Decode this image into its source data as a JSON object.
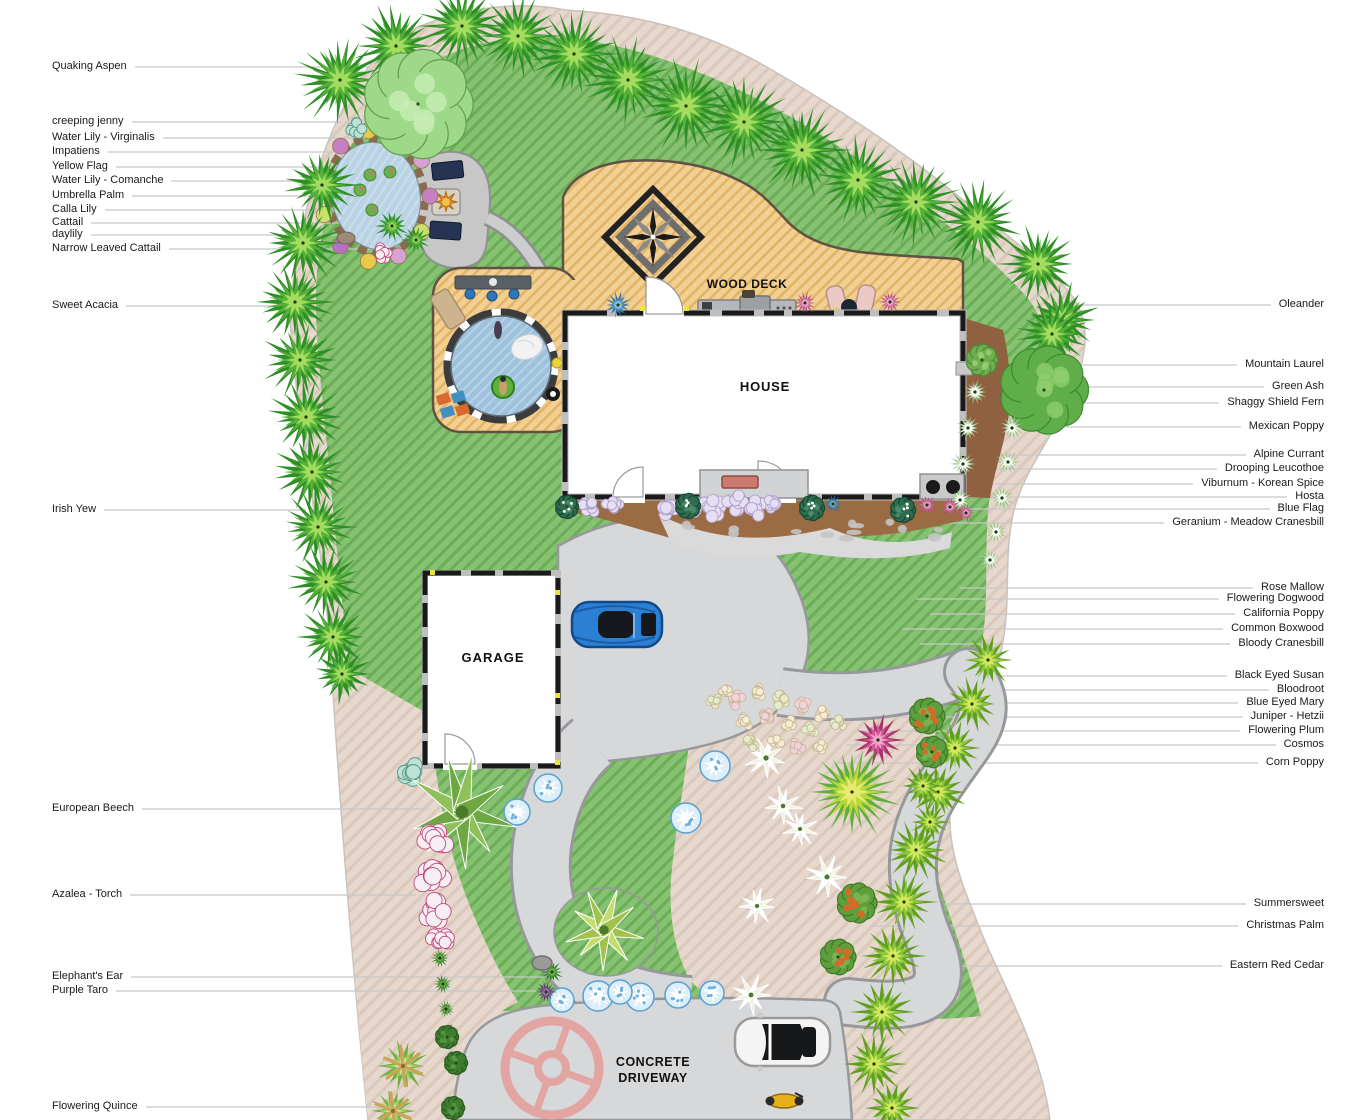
{
  "plan": {
    "wood_deck": "WOOD DECK",
    "house": "HOUSE",
    "garage": "GARAGE",
    "driveway_line1": "CONCRETE",
    "driveway_line2": "DRIVEWAY"
  },
  "plant_labels_left": [
    {
      "label": "Quaking Aspen",
      "y": 67,
      "tx": 370
    },
    {
      "label": "creeping jenny",
      "y": 122,
      "tx": 342
    },
    {
      "label": "Water Lily - Virginalis",
      "y": 138,
      "tx": 368
    },
    {
      "label": "Impatiens",
      "y": 152,
      "tx": 334
    },
    {
      "label": "Yellow Flag",
      "y": 167,
      "tx": 342
    },
    {
      "label": "Water Lily - Comanche",
      "y": 181,
      "tx": 362
    },
    {
      "label": "Umbrella Palm",
      "y": 196,
      "tx": 352
    },
    {
      "label": "Calla Lily",
      "y": 210,
      "tx": 346
    },
    {
      "label": "Cattail",
      "y": 223,
      "tx": 356
    },
    {
      "label": "daylily",
      "y": 235,
      "tx": 348
    },
    {
      "label": "Narrow Leaved Cattail",
      "y": 249,
      "tx": 386
    },
    {
      "label": "Sweet Acacia",
      "y": 306,
      "tx": 286
    },
    {
      "label": "Irish Yew",
      "y": 510,
      "tx": 306
    },
    {
      "label": "European Beech",
      "y": 809,
      "tx": 428
    },
    {
      "label": "Azalea - Torch",
      "y": 895,
      "tx": 416
    },
    {
      "label": "Elephant's Ear",
      "y": 977,
      "tx": 544
    },
    {
      "label": "Purple Taro",
      "y": 991,
      "tx": 536
    },
    {
      "label": "Flowering Quince",
      "y": 1107,
      "tx": 382
    }
  ],
  "plant_labels_right": [
    {
      "label": "Oleander",
      "y": 305,
      "tx": 1076
    },
    {
      "label": "Mountain Laurel",
      "y": 365,
      "tx": 1050
    },
    {
      "label": "Green Ash",
      "y": 387,
      "tx": 1008
    },
    {
      "label": "Shaggy Shield Fern",
      "y": 403,
      "tx": 1006
    },
    {
      "label": "Mexican Poppy",
      "y": 427,
      "tx": 1032
    },
    {
      "label": "Alpine Currant",
      "y": 455,
      "tx": 990
    },
    {
      "label": "Drooping Leucothoe",
      "y": 469,
      "tx": 976
    },
    {
      "label": "Viburnum - Korean Spice",
      "y": 484,
      "tx": 944
    },
    {
      "label": "Hosta",
      "y": 497,
      "tx": 900
    },
    {
      "label": "Blue Flag",
      "y": 509,
      "tx": 870
    },
    {
      "label": "Geranium - Meadow Cranesbill",
      "y": 523,
      "tx": 834
    },
    {
      "label": "Rose Mallow",
      "y": 588,
      "tx": 960
    },
    {
      "label": "Flowering Dogwood",
      "y": 599,
      "tx": 916
    },
    {
      "label": "California Poppy",
      "y": 614,
      "tx": 930
    },
    {
      "label": "Common Boxwood",
      "y": 629,
      "tx": 902
    },
    {
      "label": "Bloody Cranesbill",
      "y": 644,
      "tx": 920
    },
    {
      "label": "Black Eyed Susan",
      "y": 676,
      "tx": 952
    },
    {
      "label": "Bloodroot",
      "y": 690,
      "tx": 898
    },
    {
      "label": "Blue Eyed Mary",
      "y": 703,
      "tx": 870
    },
    {
      "label": "Juniper - Hetzii",
      "y": 717,
      "tx": 890
    },
    {
      "label": "Flowering Plum",
      "y": 731,
      "tx": 860
    },
    {
      "label": "Cosmos",
      "y": 745,
      "tx": 846
    },
    {
      "label": "Corn Poppy",
      "y": 763,
      "tx": 836
    },
    {
      "label": "Summersweet",
      "y": 904,
      "tx": 900
    },
    {
      "label": "Christmas Palm",
      "y": 926,
      "tx": 870
    },
    {
      "label": "Eastern Red Cedar",
      "y": 966,
      "tx": 940
    }
  ],
  "colors": {
    "lawn": "#86c272",
    "lawn_stripe": "#6cae58",
    "deck": "#f2cf92",
    "deck_stripe": "#e2b465",
    "path_base": "#e7d8ce",
    "path_stripe": "#dcc9bd",
    "water": "#b9d2e4",
    "pool_water": "#9ec2dc",
    "driveway": "#d7d8da",
    "driveway_edge": "#97989b",
    "leader_line": "#c7c7c7",
    "wall": "#1a1a1a",
    "medallion": "#e2a5a2",
    "mulch": "#8f6140",
    "blue_car": "#2b7fd4",
    "white_car": "#f4f4f4",
    "motorcycle": "#e8b11c"
  }
}
